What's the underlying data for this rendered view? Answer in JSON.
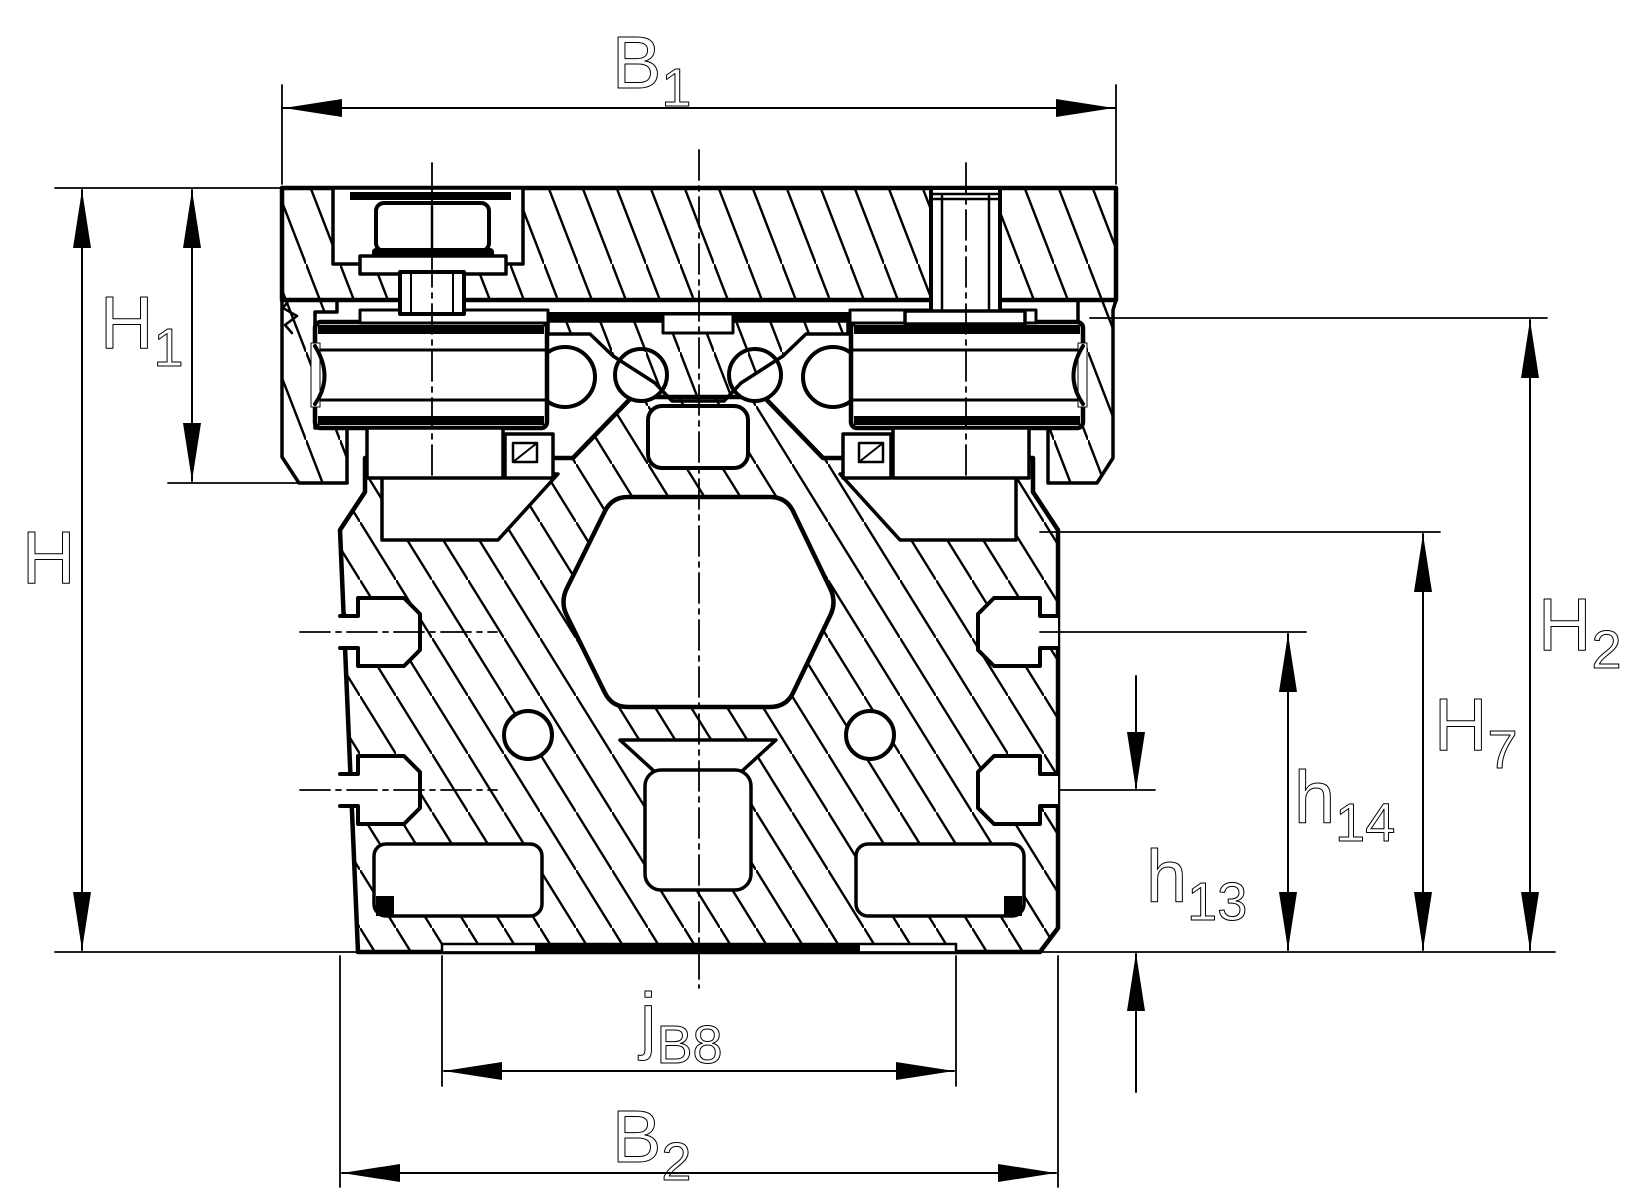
{
  "drawing": {
    "kind": "technical cross-section drawing",
    "background_color": "#ffffff",
    "line_color": "#000000"
  },
  "dimensions": {
    "B1": {
      "base": "B",
      "sub": "1"
    },
    "H": {
      "base": "H",
      "sub": ""
    },
    "H1": {
      "base": "H",
      "sub": "1"
    },
    "H2": {
      "base": "H",
      "sub": "2"
    },
    "H7": {
      "base": "H",
      "sub": "7"
    },
    "h14": {
      "base": "h",
      "sub": "14"
    },
    "h13": {
      "base": "h",
      "sub": "13"
    },
    "jB8": {
      "base": "j",
      "sub": "B8"
    },
    "B2": {
      "base": "B",
      "sub": "2"
    }
  }
}
